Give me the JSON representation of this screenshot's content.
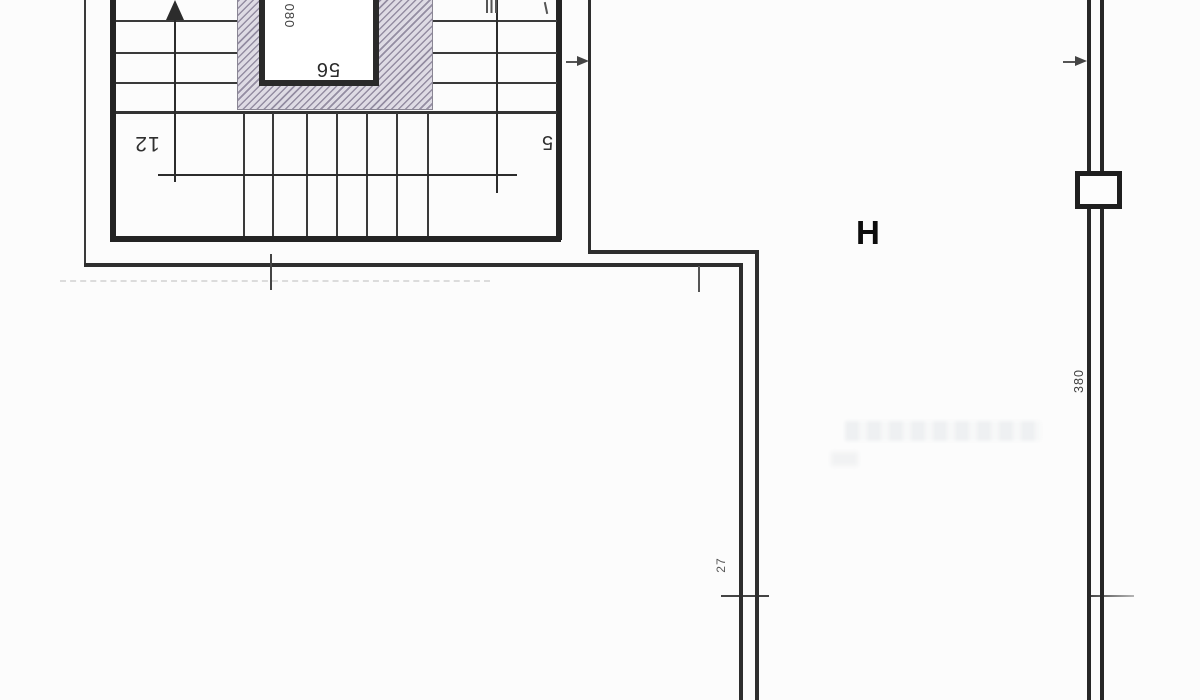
{
  "drawing": {
    "kind": "scanned architectural floor plan — staircase with elevator shaft, corridor walls",
    "room_label": "H",
    "stair": {
      "left_flight_label": "12",
      "right_flight_label": "5"
    },
    "elevator_shaft": {
      "width_label": "56",
      "side_label": "080"
    },
    "wall_dimensions": {
      "right_wall_label": "380",
      "center_wall_label": "27"
    },
    "colors": {
      "paper": "#fcfcfc",
      "line": "#2c2c2c",
      "hatch_dark": "#948da2",
      "hatch_light": "#dedbe4"
    }
  }
}
